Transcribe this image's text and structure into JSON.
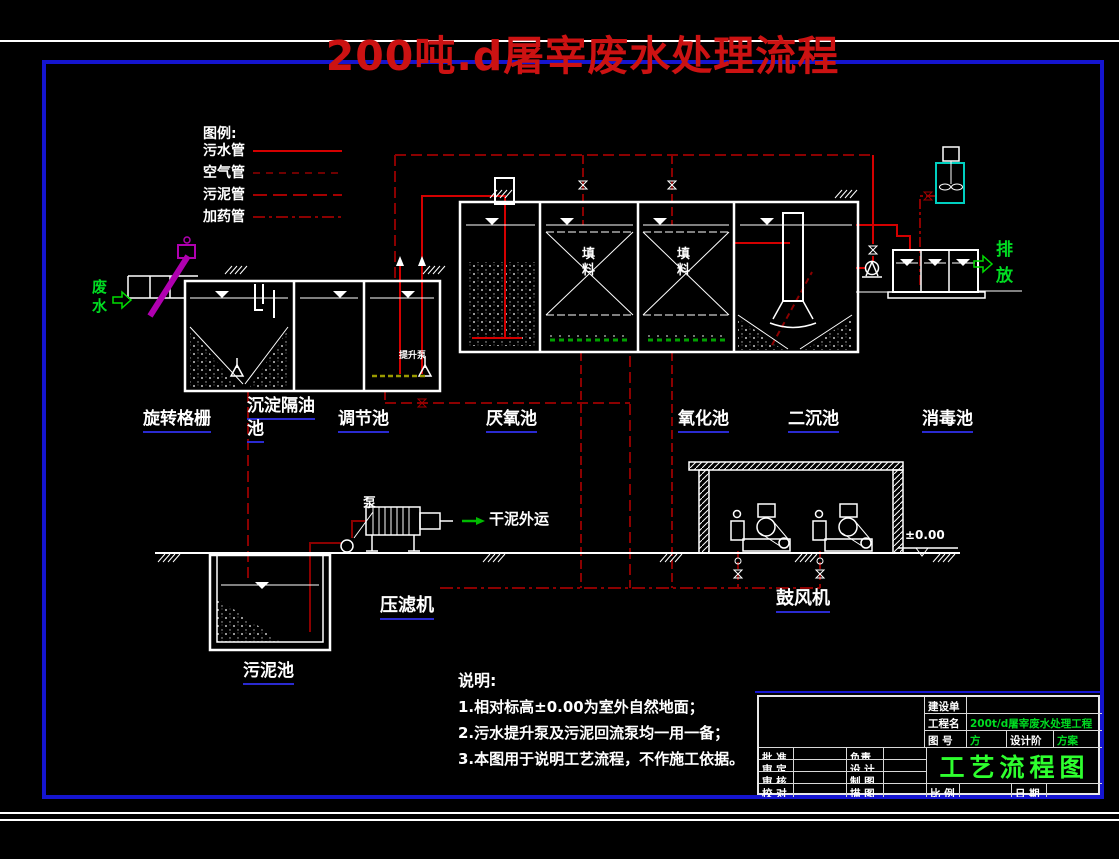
{
  "title": "200吨.d屠宰废水处理流程",
  "legend": {
    "heading": "图例:",
    "items": [
      "污水管",
      "空气管",
      "污泥管",
      "加药管"
    ]
  },
  "flow": {
    "influent": "废水",
    "effluent": "排放",
    "dry_sludge": "干泥外运",
    "pump": "泵",
    "lift_pump": "提升泵",
    "media": "填料",
    "elevation": "±0.00"
  },
  "units": {
    "rotary_screen": "旋转格栅",
    "sedimentation_line1": "沉淀隔油",
    "sedimentation_line2": "池",
    "regulating": "调节池",
    "anaerobic": "厌氧池",
    "oxidation": "氧化池",
    "secondary_clarifier": "二沉池",
    "disinfection": "消毒池",
    "sludge_pool": "污泥池",
    "filter_press": "压滤机",
    "blower": "鼓风机"
  },
  "notes": {
    "heading": "说明:",
    "items": [
      "1.相对标高±0.00为室外自然地面；",
      "2.污水提升泵及污泥回流泵均一用一备；",
      "3.本图用于说明工艺流程，不作施工依据。"
    ]
  },
  "title_block": {
    "owner_label": "建设单位",
    "project_label": "工程名称",
    "project_value": "200t/d屠宰废水处理工程",
    "drawing_no_label": "图  号",
    "drawing_no_value": "方案-01",
    "stage_label": "设计阶段",
    "stage_value": "方案",
    "rows_left": [
      "批 准",
      "审 定",
      "审 核",
      "校 对"
    ],
    "rows_mid": [
      "负责人",
      "设 计",
      "制 图",
      "描 图"
    ],
    "scale_label": "比 例",
    "date_label": "日 期",
    "drawing_title": "工艺流程图"
  },
  "colors": {
    "title_red": "#cc1212",
    "pipe_sewage_red": "#d40000",
    "pipe_dark_red": "#8b0000",
    "frame_blue": "#1515d0",
    "underline_blue": "#2a2ad0",
    "text_green": "#00dd22",
    "screen_magenta": "#b000b0",
    "dosing_cyan": "#00cfc0",
    "aeration_green": "#00a000",
    "aeration_yellow": "#9a9a00"
  }
}
